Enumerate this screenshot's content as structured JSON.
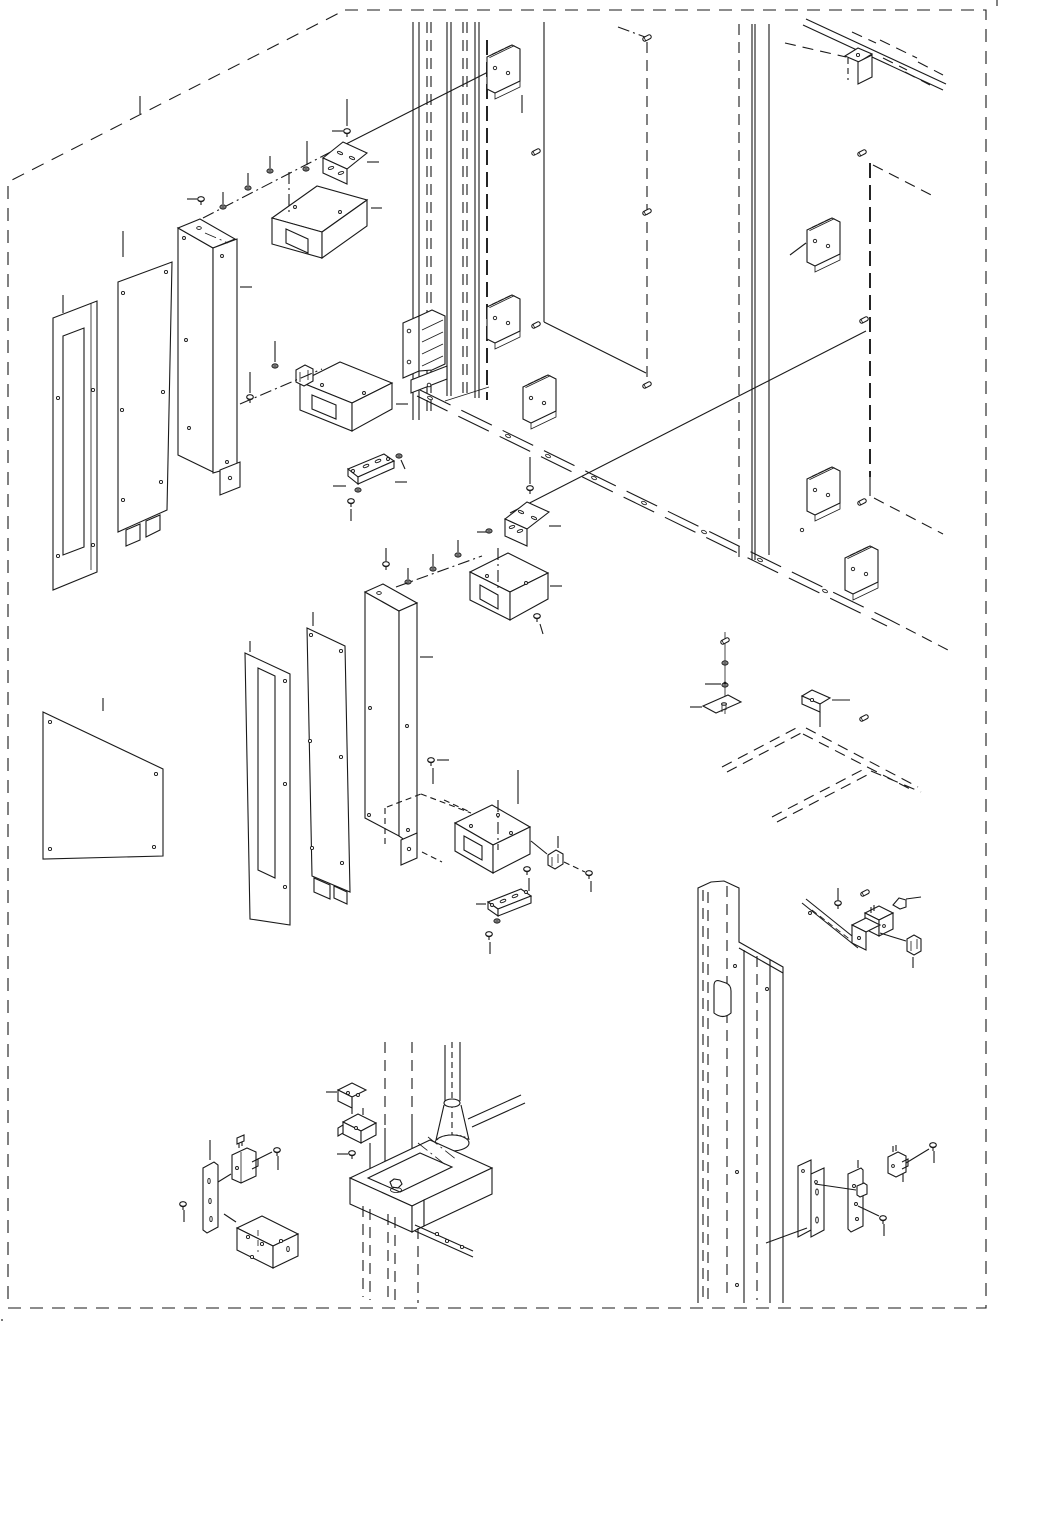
{
  "page": {
    "type": "exploded-isometric-parts-diagram",
    "background_color": "#ffffff",
    "line_color": "#1a1a1a",
    "visible_text": [],
    "border": {
      "style": "dashed",
      "shape": "rectangle-with-cut-top-left-corner"
    }
  },
  "diagram": {
    "description": "Exploded isometric line drawing of a cabinet/frame assembly showing panels, columns, brackets, rails, switches and fasteners connected by leader lines. No part numbers or text are printed on the drawing.",
    "parts": [
      {
        "name": "slotted-side-panel",
        "qty": 2
      },
      {
        "name": "plain-side-panel",
        "qty": 2
      },
      {
        "name": "support-column",
        "qty": 2
      },
      {
        "name": "u-channel-bracket",
        "qty": 4
      },
      {
        "name": "l-angle-bracket",
        "qty": 2
      },
      {
        "name": "flat-link-bar",
        "qty": 2
      },
      {
        "name": "din-rail-plate",
        "qty": 6
      },
      {
        "name": "hinge-latch-assembly",
        "qty": 1
      },
      {
        "name": "top-corner-bracket",
        "qty": 1
      },
      {
        "name": "back-panel",
        "qty": 1
      },
      {
        "name": "base-leg-assembly",
        "qty": 1
      },
      {
        "name": "leveler-foot",
        "qty": 1
      },
      {
        "name": "micro-switch",
        "qty": 2
      },
      {
        "name": "switch-mounting-plate",
        "qty": 3
      },
      {
        "name": "z-mounting-bracket",
        "qty": 1
      },
      {
        "name": "cable-clamp",
        "qty": 4
      },
      {
        "name": "frame-rail-ghost-outline",
        "qty": 1
      },
      {
        "name": "screws-nuts-washers",
        "qty": 30
      }
    ]
  }
}
